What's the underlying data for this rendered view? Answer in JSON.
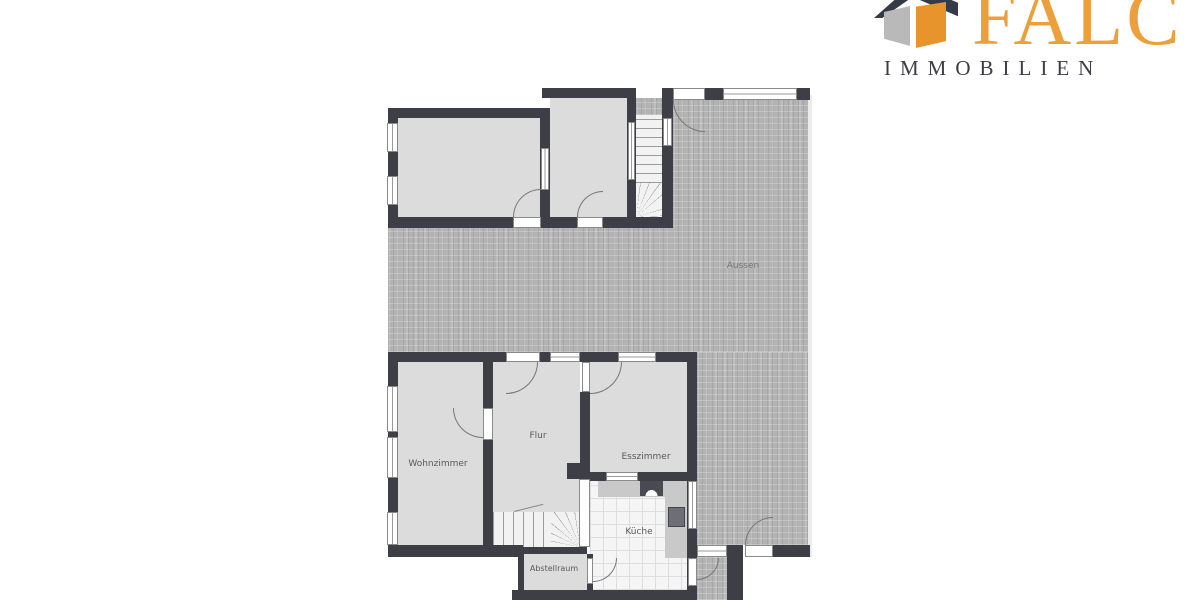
{
  "brand": {
    "name": "FALC",
    "subtitle": "IMMOBILIEN",
    "icon": "house-cube-icon",
    "colors": {
      "brand_orange": "#EC9F3A",
      "brand_dark": "#3D3D47",
      "brand_gray": "#B9B9B9"
    }
  },
  "plan": {
    "type": "floor-plan",
    "rooms": {
      "wohnzimmer": {
        "label": "Wohnzimmer"
      },
      "flur": {
        "label": "Flur"
      },
      "esszimmer": {
        "label": "Esszimmer"
      },
      "kueche": {
        "label": "Küche"
      },
      "abstellraum": {
        "label": "Abstellraum"
      },
      "aussen": {
        "label": "Aussen"
      }
    },
    "features": [
      "winder-stairs-upper",
      "winder-stairs-lower",
      "terrace",
      "railing",
      "kitchen-counter",
      "stove",
      "sink"
    ],
    "colors": {
      "wall": "#3E3E47",
      "room_floor": "#DCDCDC",
      "terrace": "#B3B3B3",
      "kitchen_tile": "#F5F5F5"
    }
  }
}
